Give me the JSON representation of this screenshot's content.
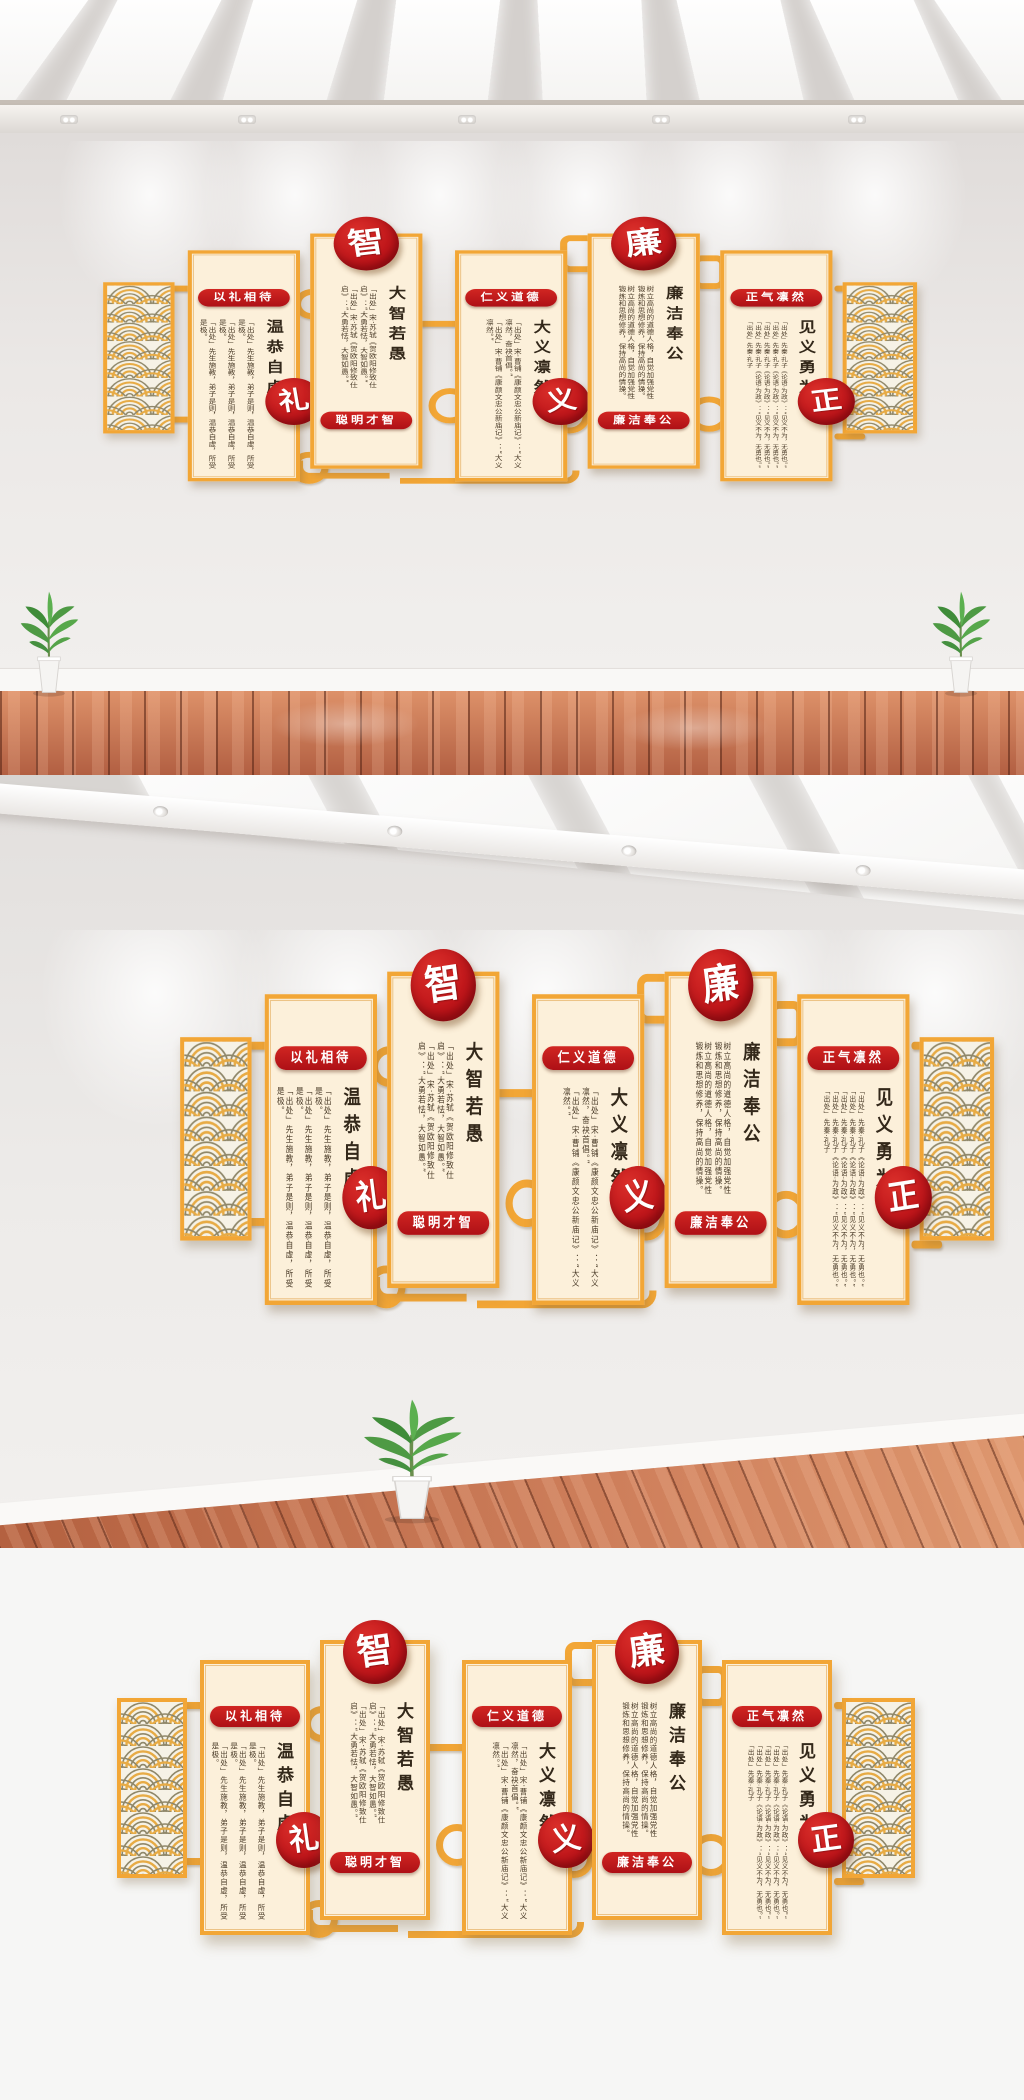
{
  "wall": {
    "panels": [
      {
        "header": "以礼相待",
        "big": "温恭自虚",
        "circle": "礼",
        "passages": [
          "「出处」先生施教，弟子是则，温恭自虚，所受是极。",
          "「出处」先生施教，弟子是则，温恭自虚，所受是极。",
          "「出处」先生施教，弟子是则，温恭自虚，所受是极。",
          "「出处」先生施教"
        ]
      },
      {
        "circle": "智",
        "big": "大智若愚",
        "band": "聪明才智",
        "passages": [
          "「出处」宋·苏轼《贺欧阳修致仕启》：“大勇若怯，大智如愚。”",
          "「出处」宋·苏轼《贺欧阳修致仕启》：“大勇若怯，大智如愚。”"
        ]
      },
      {
        "header": "仁义道德",
        "big": "大义凛然",
        "circle": "义",
        "passages": [
          "「出处」宋·曹铺《康颜文忠公新庙记》：“大义凛然，奋袂首倡。”",
          "「出处」宋·曹铺《康颜文忠公新庙记》：“大义凛然。”"
        ]
      },
      {
        "circle": "廉",
        "big": "廉洁奉公",
        "band": "廉洁奉公",
        "passages": [
          "树立高尚的道德人格，自觉加强党性锻炼和思想修养，保持高尚的情操。",
          "树立高尚的道德人格，自觉加强党性锻炼和思想修养，保持高尚的情操。"
        ]
      },
      {
        "header": "正气凛然",
        "big": "见义勇为",
        "circle": "正",
        "passages": [
          "「出处」先秦·孔子《论语·为政》：“见义不为，无勇也。”",
          "「出处」先秦·孔子《论语·为政》：“见义不为，无勇也。”",
          "「出处」先秦·孔子《论语·为政》：“见义不为，无勇也。”",
          "「出处」先秦·孔子《论语·为政》：“见义不为，无勇也。”",
          "「出处」先秦·孔子"
        ]
      }
    ],
    "colors": {
      "gold": "#f2a636",
      "gold-deep": "#d98c1e",
      "cream": "#fcf0da",
      "red": "#c4161c",
      "wave-olive": "#8f8769",
      "wood": "#c0704f",
      "wall": "#e9e6e4"
    }
  }
}
